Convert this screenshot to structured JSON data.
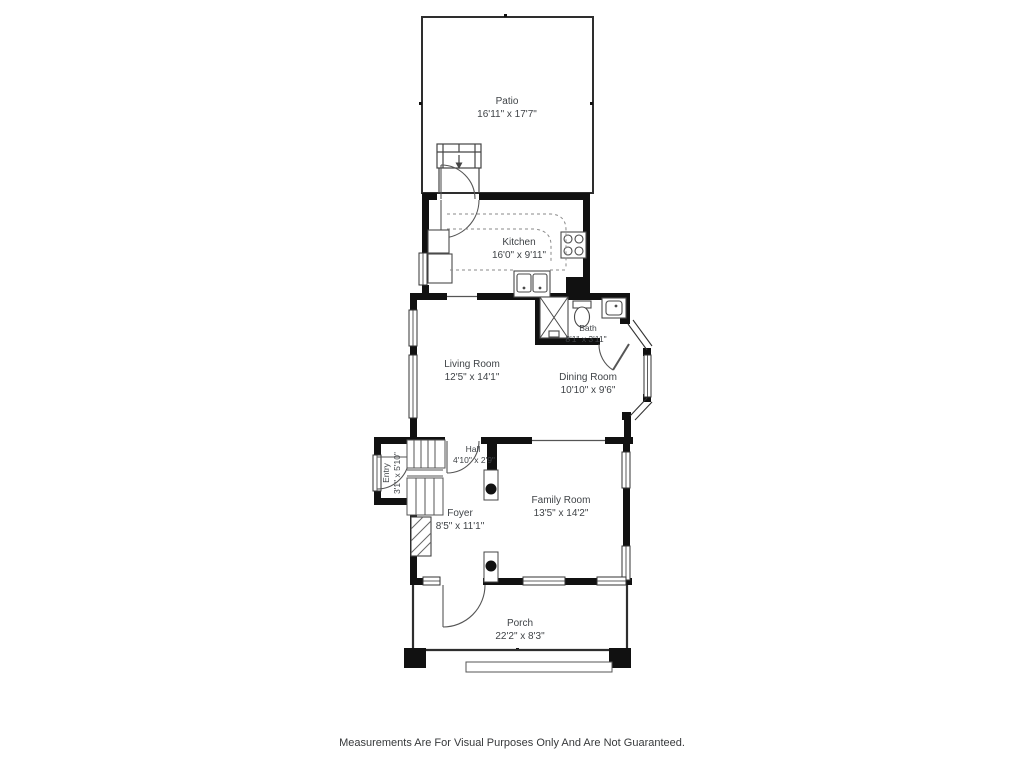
{
  "plan_title": "Residential Floor Plan",
  "disclaimer": "Measurements Are For Visual Purposes Only And Are Not Guaranteed.",
  "rooms": {
    "patio": {
      "name": "Patio",
      "dims": "16'11\" x 17'7\""
    },
    "kitchen": {
      "name": "Kitchen",
      "dims": "16'0\" x 9'11\""
    },
    "bath": {
      "name": "Bath",
      "dims": "8'1\" x 3'11\""
    },
    "living": {
      "name": "Living Room",
      "dims": "12'5\" x 14'1\""
    },
    "dining": {
      "name": "Dining Room",
      "dims": "10'10\" x 9'6\""
    },
    "hall": {
      "name": "Hall",
      "dims": "4'10\" x 2'9\""
    },
    "entry": {
      "name": "Entry",
      "dims": "3'1\" x 5'10\""
    },
    "foyer": {
      "name": "Foyer",
      "dims": "8'5\" x 11'1\""
    },
    "family": {
      "name": "Family Room",
      "dims": "13'5\" x 14'2\""
    },
    "porch": {
      "name": "Porch",
      "dims": "22'2\" x 8'3\""
    }
  },
  "fixtures": [
    "patio-steps",
    "exterior-door",
    "refrigerator",
    "kitchen-counter",
    "stove-burners",
    "double-basin-sink",
    "shower",
    "toilet",
    "bath-sink",
    "staircase",
    "fireplace",
    "structural-post",
    "bay-window",
    "porch-step"
  ],
  "colors": {
    "wall": "#111111",
    "thin_line": "#2e2e2e",
    "fixture_line": "#4a4a4a",
    "counter_dash": "#8a8a8a",
    "text": "#3f4347",
    "background": "#ffffff"
  }
}
